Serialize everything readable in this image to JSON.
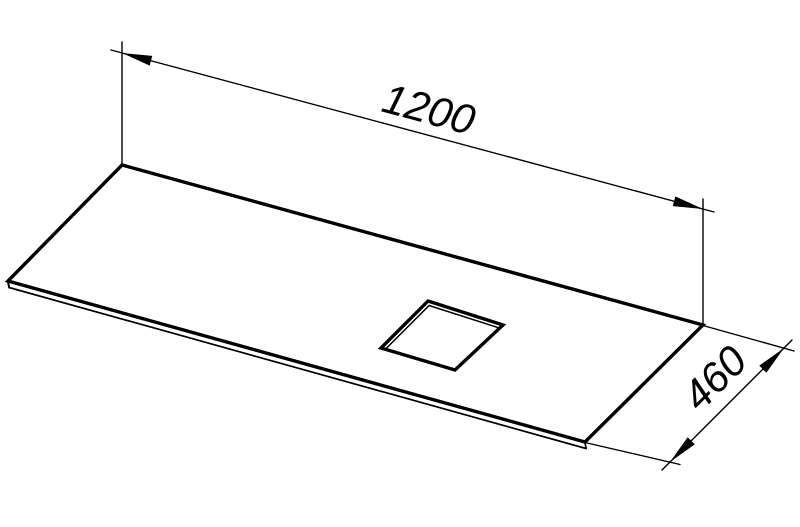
{
  "drawing": {
    "kind": "isometric-technical-drawing",
    "subject": "flat-panel-with-square-cutout",
    "background_color": "#ffffff",
    "line_color": "#000000",
    "dimensions": [
      {
        "name": "length",
        "value": "1200"
      },
      {
        "name": "depth",
        "value": "460"
      }
    ]
  }
}
